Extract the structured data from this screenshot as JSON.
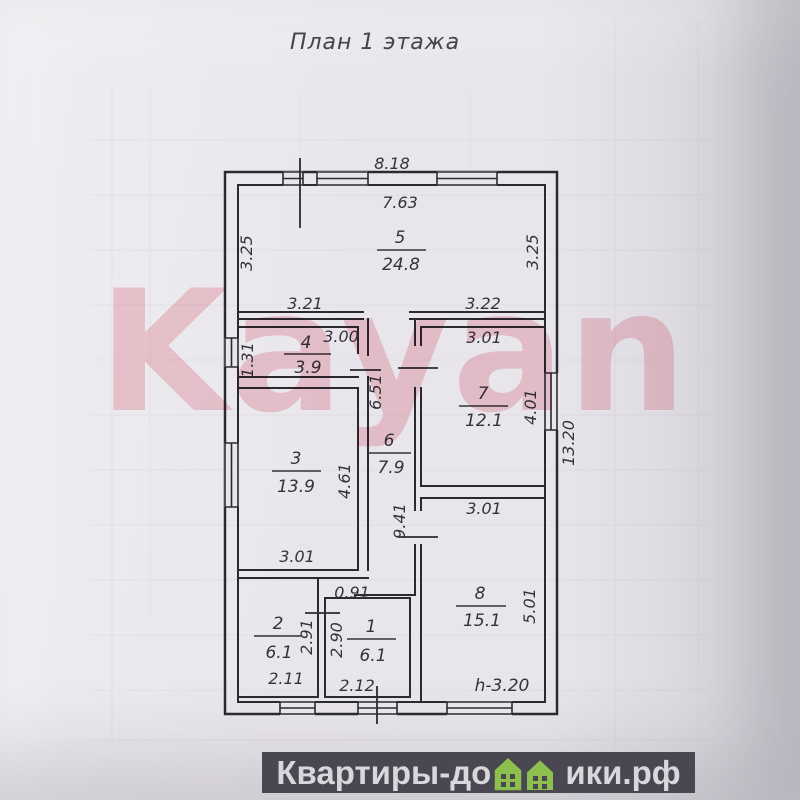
{
  "title": "План 1 этажа",
  "watermark": "Kayan",
  "footer": {
    "text_before_icon": "Квартиры-до",
    "text_after_icon": "ики.рф",
    "icon": "green-houses-icon",
    "bar_color": "#494751",
    "text_color": "#d8d7db",
    "house_color": "#8cbf4d"
  },
  "plan": {
    "rooms": {
      "r1": {
        "number": "1",
        "area": "6.1"
      },
      "r2": {
        "number": "2",
        "area": "6.1"
      },
      "r3": {
        "number": "3",
        "area": "13.9"
      },
      "r4": {
        "number": "4",
        "area": "3.9"
      },
      "r5": {
        "number": "5",
        "area": "24.8"
      },
      "r6": {
        "number": "6",
        "area": "7.9"
      },
      "r7": {
        "number": "7",
        "area": "12.1"
      },
      "r8": {
        "number": "8",
        "area": "15.1"
      }
    },
    "dims": {
      "top_outer": "8.18",
      "top_inner": "7.63",
      "r5_left": "3.25",
      "r5_right": "3.25",
      "r5_bottom_left": "3.21",
      "r5_bottom_right": "3.22",
      "r4_top": "3.00",
      "r4_left_window": "1.31",
      "corridor_upper": "6.51",
      "corridor_lower": "9.41",
      "r3_right": "4.61",
      "r3_bottom": "3.01",
      "r7_top": "3.01",
      "r7_right": "4.01",
      "right_overall": "13.20",
      "r8_top": "3.01",
      "r8_right": "5.01",
      "r2_right": "2.91",
      "r2_bottom": "2.11",
      "r1_left": "2.90",
      "r1_bottom": "2.12",
      "passage_width": "0.91",
      "ceiling_height": "h-3.20"
    }
  }
}
